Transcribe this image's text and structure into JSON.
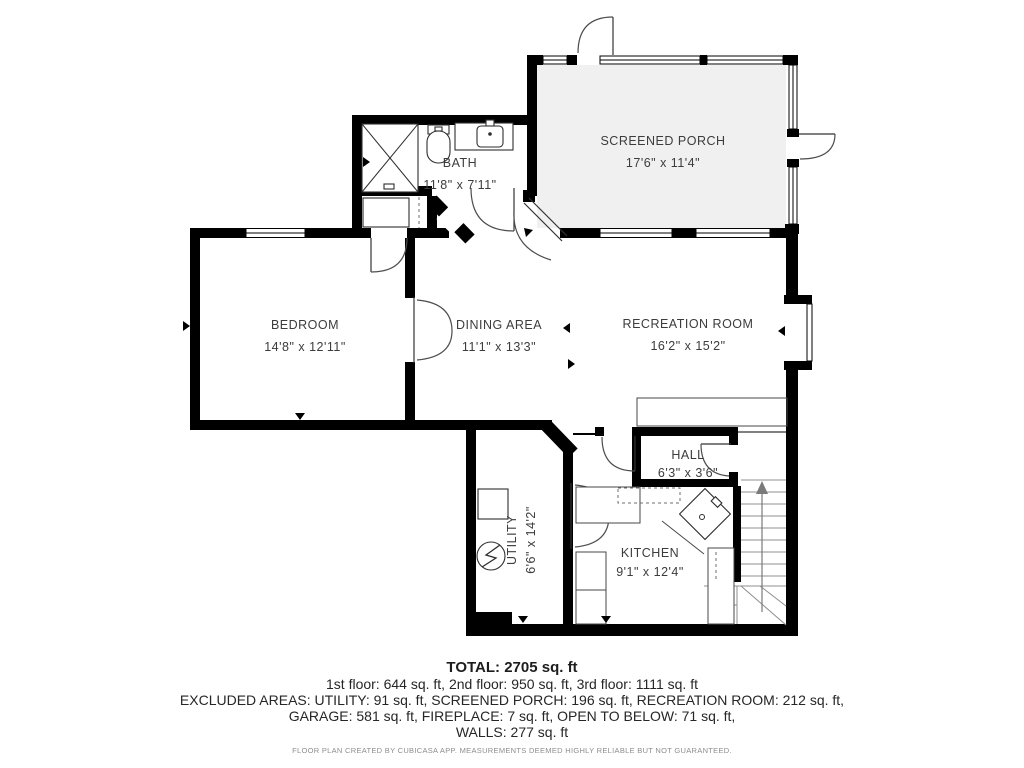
{
  "plan": {
    "rooms": [
      {
        "name": "BATH",
        "dims": "11'8\" x 7'11\""
      },
      {
        "name": "SCREENED PORCH",
        "dims": "17'6\" x 11'4\""
      },
      {
        "name": "BEDROOM",
        "dims": "14'8\" x 12'11\""
      },
      {
        "name": "DINING AREA",
        "dims": "11'1\" x 13'3\""
      },
      {
        "name": "RECREATION ROOM",
        "dims": "16'2\" x 15'2\""
      },
      {
        "name": "HALL",
        "dims": "6'3\" x 3'6\""
      },
      {
        "name": "KITCHEN",
        "dims": "9'1\" x 12'4\""
      },
      {
        "name": "UTILITY",
        "dims": "6'6\" x 14'2\""
      }
    ],
    "summary": {
      "total": "TOTAL: 2705 sq. ft",
      "floors": "1st floor: 644 sq. ft, 2nd floor: 950 sq. ft, 3rd floor: 1111 sq. ft",
      "excluded_line1": "EXCLUDED AREAS: UTILITY: 91 sq. ft, SCREENED PORCH: 196 sq. ft, RECREATION ROOM: 212 sq. ft,",
      "excluded_line2": "GARAGE: 581 sq. ft, FIREPLACE: 7 sq. ft, OPEN TO BELOW: 71 sq. ft,",
      "excluded_line3": "WALLS: 277 sq. ft",
      "disclaimer": "FLOOR PLAN CREATED BY CUBICASA APP. MEASUREMENTS DEEMED HIGHLY RELIABLE BUT NOT GUARANTEED."
    },
    "colors": {
      "wall": "#000000",
      "room_text": "#3c3c3c",
      "footer_text": "#262626",
      "disclaimer_text": "#8d8d8d",
      "porch_floor": "#f0f0f0"
    }
  }
}
